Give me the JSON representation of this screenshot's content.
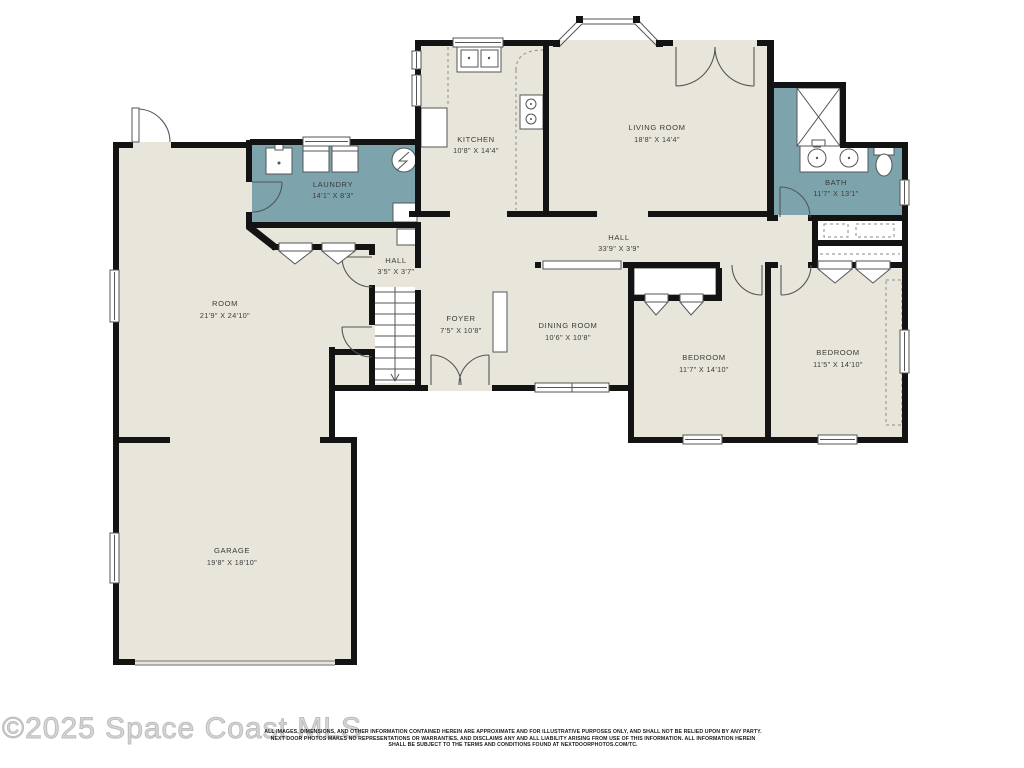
{
  "floor_plan": {
    "rooms": [
      {
        "id": "kitchen",
        "name": "KITCHEN",
        "dims": "10'8\" X 14'4\""
      },
      {
        "id": "living-room",
        "name": "LIVING ROOM",
        "dims": "18'8\" X 14'4\""
      },
      {
        "id": "bath",
        "name": "BATH",
        "dims": "11'7\" X 13'1\""
      },
      {
        "id": "laundry",
        "name": "LAUNDRY",
        "dims": "14'1\" X 8'3\""
      },
      {
        "id": "hall",
        "name": "HALL",
        "dims": "33'9\" X 3'9\""
      },
      {
        "id": "hall-small",
        "name": "HALL",
        "dims": "3'5\" X 3'7\""
      },
      {
        "id": "room",
        "name": "ROOM",
        "dims": "21'9\" X 24'10\""
      },
      {
        "id": "foyer",
        "name": "FOYER",
        "dims": "7'5\" X 10'8\""
      },
      {
        "id": "dining-room",
        "name": "DINING ROOM",
        "dims": "10'6\" X 10'8\""
      },
      {
        "id": "bedroom-1",
        "name": "BEDROOM",
        "dims": "11'7\" X 14'10\""
      },
      {
        "id": "bedroom-2",
        "name": "BEDROOM",
        "dims": "11'5\" X 14'10\""
      },
      {
        "id": "garage",
        "name": "GARAGE",
        "dims": "19'8\" X 18'10\""
      }
    ],
    "fixtures": [
      "kitchen-sink",
      "stove",
      "refrigerator",
      "laundry-sink",
      "washer",
      "dryer",
      "water-heater",
      "shower",
      "double-vanity",
      "toilet",
      "stairs-down",
      "garage-door",
      "bay-window"
    ],
    "colors": {
      "room_fill": "#e8e6da",
      "wet_room_fill": "#7da4ad",
      "wall": "#131313",
      "label_text": "#3a3a3a"
    }
  },
  "watermark": "©2025 Space Coast MLS",
  "disclaimer": {
    "line1": "ALL IMAGES, DIMENSIONS, AND OTHER INFORMATION CONTAINED HEREIN ARE APPROXIMATE AND FOR ILLUSTRATIVE PURPOSES ONLY, AND SHALL NOT BE RELIED UPON BY ANY PARTY.",
    "line2": "NEXT DOOR PHOTOS MAKES NO REPRESENTATIONS OR WARRANTIES, AND DISCLAIMS ANY AND ALL LIABILITY ARISING FROM USE OF THIS INFORMATION. ALL INFORMATION HEREIN",
    "line3": "SHALL BE SUBJECT TO THE TERMS AND CONDITIONS FOUND AT NEXTDOORPHOTOS.COM/TC."
  }
}
